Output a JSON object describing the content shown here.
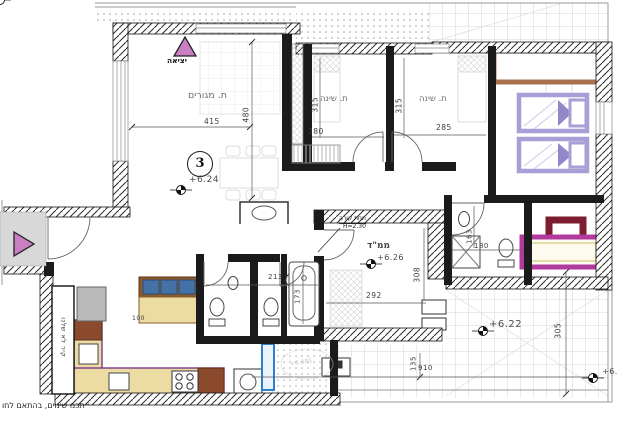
{
  "plan": {
    "unit_number": "3",
    "exit_label": "יציאה",
    "levels": {
      "living": "+6.24",
      "mamad": "+6.26",
      "terrace": "+6.22",
      "edge": "+6.",
      "stamp": "+6.085"
    },
    "rooms": {
      "living": {
        "name": "ת. מגורים",
        "width": "415",
        "height": "480"
      },
      "bedroom1": {
        "name": "ת. שינה",
        "depth": "315",
        "width": "280"
      },
      "bedroom2": {
        "name": "ת. שינה",
        "depth": "315",
        "width": "285"
      },
      "mamad": {
        "name": "ממ\"ד",
        "width": "292",
        "depth": "308"
      }
    },
    "annotations": {
      "beam": "תחת קורה",
      "beam_h": "H=2.30",
      "wall_note": "קיר לא שלנו",
      "note_bottom": "״תכנו שינוים, בהתאם לחו"
    },
    "dims": {
      "bath_w": "213",
      "tub_l": "173",
      "bath2_w": "180",
      "bath2_d": "163",
      "terrace_d": "305",
      "terrace_w": "910",
      "terrace_s": "135",
      "sofa": "100"
    }
  }
}
